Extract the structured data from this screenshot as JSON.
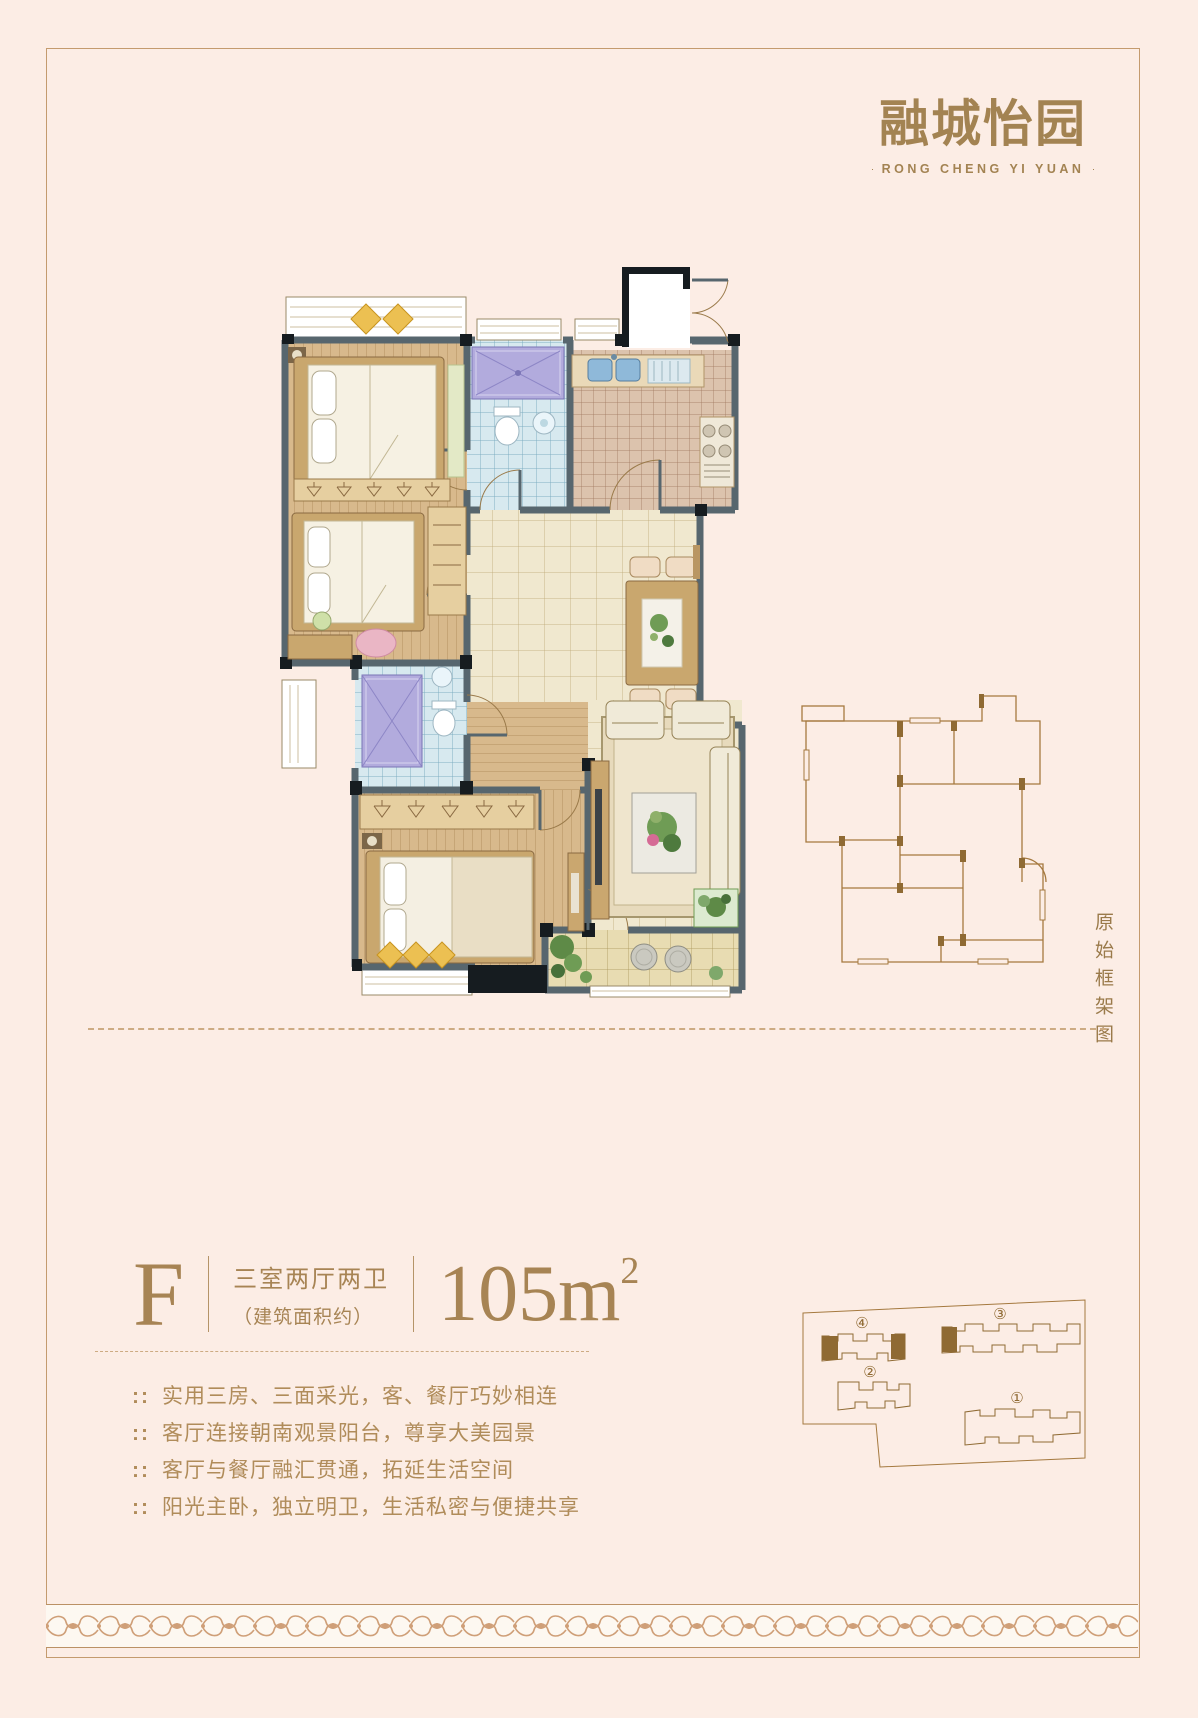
{
  "page": {
    "background": "#fcede5",
    "accent_gold": "#a78454",
    "frame_color": "#c49b6e"
  },
  "logo": {
    "title": "融城怡园",
    "subtitle": "RONG CHENG YI YUAN"
  },
  "frame_diagram": {
    "caption": "原始框架图"
  },
  "unit": {
    "letter": "F",
    "layout": "三室两厅两卫",
    "area_label": "（建筑面积约）",
    "area_value": "105m",
    "area_sup": "2"
  },
  "features": {
    "bullet": "::",
    "items": [
      "实用三房、三面采光，客、餐厅巧妙相连",
      "客厅连接朝南观景阳台，尊享大美园景",
      "客厅与餐厅融汇贯通，拓延生活空间",
      "阳光主卧，独立明卫，生活私密与便捷共享"
    ]
  },
  "site_plan": {
    "labels": {
      "b1": "①",
      "b2": "②",
      "b3": "③",
      "b4": "④"
    }
  }
}
